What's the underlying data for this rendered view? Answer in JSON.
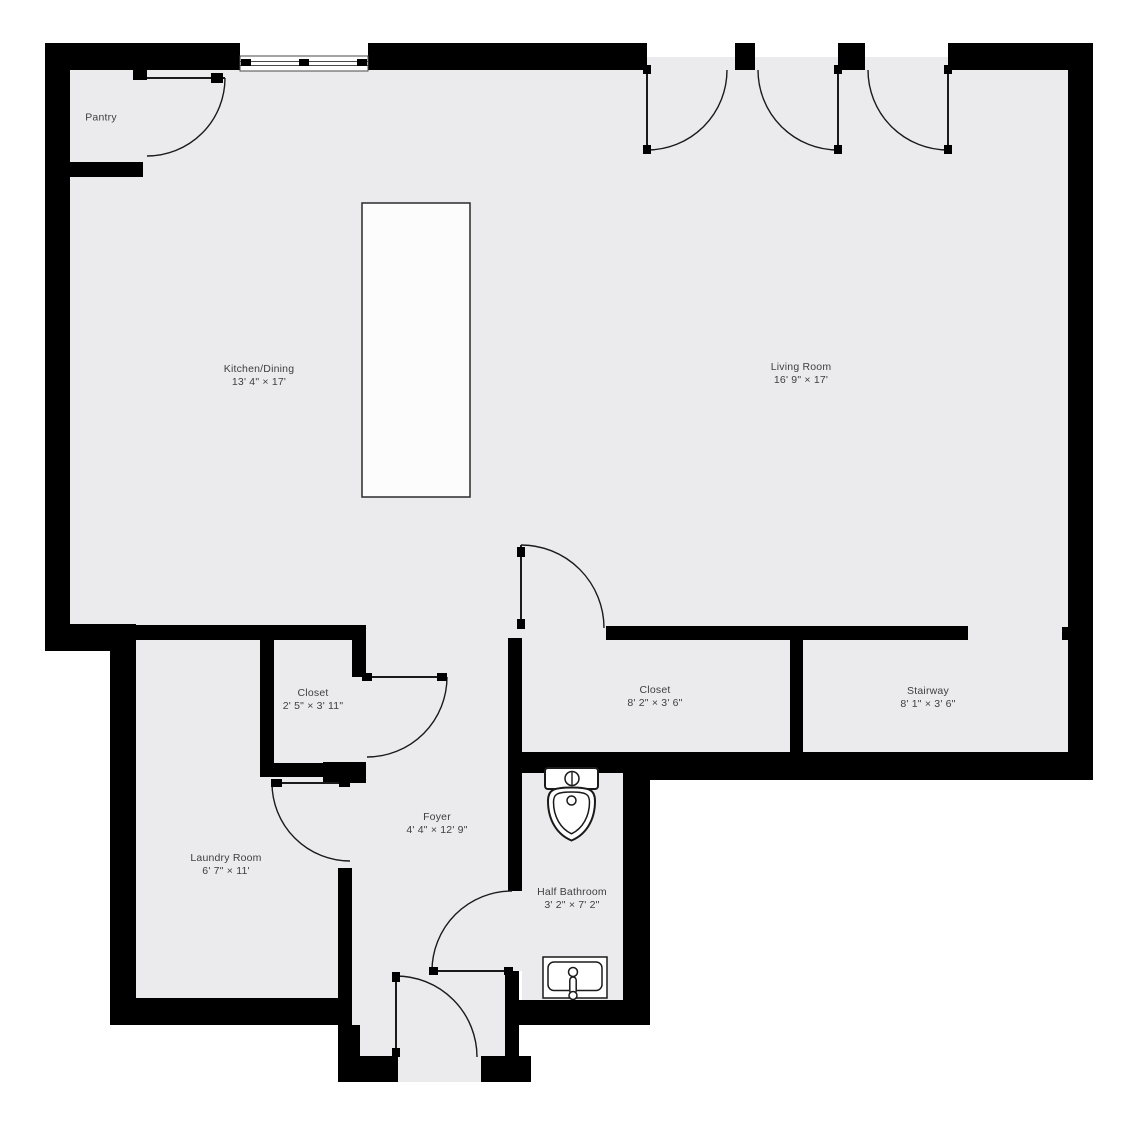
{
  "plan": {
    "title": "First floor plan",
    "colors": {
      "background": "#ffffff",
      "floor": "#ebebee",
      "wall": "#000000",
      "line": "#1a1a1a",
      "island_fill": "#fcfcfc",
      "label_text": "#3e3e3e"
    },
    "dimension_separator": "×"
  },
  "rooms": [
    {
      "id": "pantry",
      "name": "Pantry",
      "dims": "",
      "cx": 101,
      "cy": 118
    },
    {
      "id": "kitchen-dining",
      "name": "Kitchen/Dining",
      "dims": "13' 4\" × 17'",
      "cx": 259,
      "cy": 376
    },
    {
      "id": "living-room",
      "name": "Living Room",
      "dims": "16' 9\" × 17'",
      "cx": 801,
      "cy": 374
    },
    {
      "id": "closet-small",
      "name": "Closet",
      "dims": "2' 5\" × 3' 11\"",
      "cx": 313,
      "cy": 700
    },
    {
      "id": "closet-hall",
      "name": "Closet",
      "dims": "8' 2\" × 3' 6\"",
      "cx": 655,
      "cy": 697
    },
    {
      "id": "stairway",
      "name": "Stairway",
      "dims": "8' 1\" × 3' 6\"",
      "cx": 928,
      "cy": 698
    },
    {
      "id": "foyer",
      "name": "Foyer",
      "dims": "4' 4\" × 12' 9\"",
      "cx": 437,
      "cy": 824
    },
    {
      "id": "laundry-room",
      "name": "Laundry Room",
      "dims": "6' 7\" × 11'",
      "cx": 226,
      "cy": 865
    },
    {
      "id": "half-bathroom",
      "name": "Half Bathroom",
      "dims": "3' 2\" × 7' 2\"",
      "cx": 572,
      "cy": 899
    }
  ],
  "fixtures": [
    {
      "name": "kitchen-island"
    },
    {
      "name": "toilet"
    },
    {
      "name": "bathroom-sink"
    },
    {
      "name": "window"
    }
  ],
  "doors": [
    {
      "name": "pantry-door"
    },
    {
      "name": "patio-door-left"
    },
    {
      "name": "patio-door-middle"
    },
    {
      "name": "patio-door-right"
    },
    {
      "name": "hall-closet-door"
    },
    {
      "name": "small-closet-door"
    },
    {
      "name": "laundry-door"
    },
    {
      "name": "bathroom-door"
    },
    {
      "name": "entry-door"
    }
  ]
}
